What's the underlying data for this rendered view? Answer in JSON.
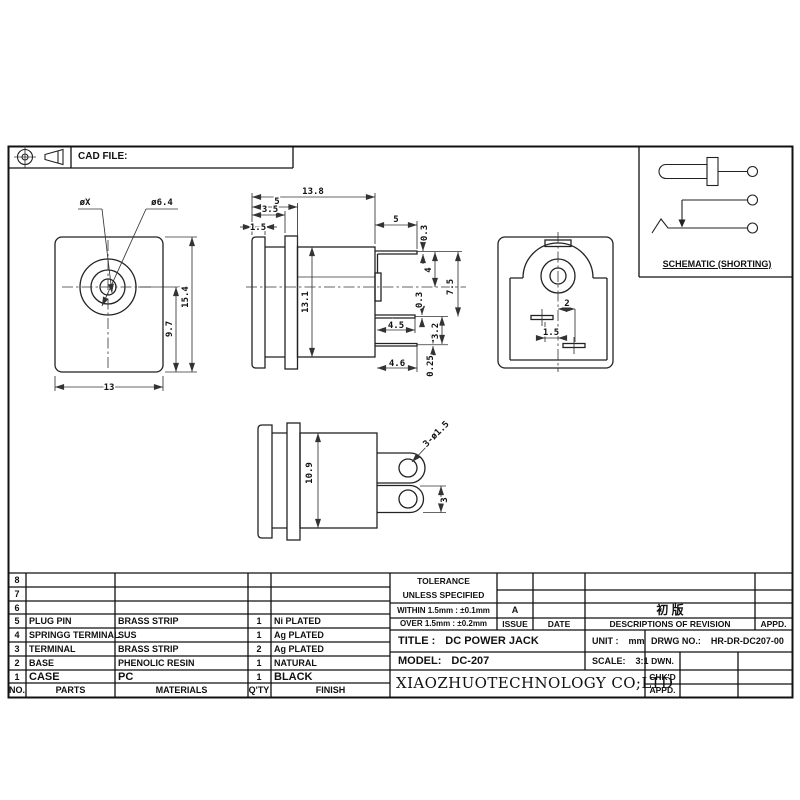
{
  "header": {
    "cad_file_label": "CAD FILE:"
  },
  "schematic": {
    "caption": "SCHEMATIC (SHORTING)"
  },
  "dims": {
    "front": {
      "pin_dia": "øX",
      "opening_dia": "ø6.4",
      "total_height": "15.4",
      "center_to_bottom": "9.7",
      "width": "13"
    },
    "side": {
      "total_depth": "13.8",
      "head_depth": "5",
      "step_depth": "3.5",
      "flange_thickness": "1.5",
      "body_height": "13.1",
      "top_terminal_length": "5",
      "top_terminal_thickness": "0.3",
      "pin_height": "4",
      "terminal_span": "7.5",
      "mid_terminal_thickness": "0.3",
      "mid_terminal_length": "4.5",
      "terminal_gap": "3.2",
      "bottom_terminal_thickness": "0.25",
      "bottom_terminal_length": "4.6"
    },
    "back": {
      "right_slot_offset": "2",
      "left_slot_offset": "1.5"
    },
    "bottom": {
      "body_width": "10.9",
      "hole_spec": "3-ø1.5",
      "terminal_width": "3"
    }
  },
  "parts_table": {
    "headers": {
      "no": "NO.",
      "parts": "PARTS",
      "materials": "MATERIALS",
      "qty": "Q'TY",
      "finish": "FINISH"
    },
    "rows": [
      {
        "no": "8",
        "part": "",
        "material": "",
        "qty": "",
        "finish": ""
      },
      {
        "no": "7",
        "part": "",
        "material": "",
        "qty": "",
        "finish": ""
      },
      {
        "no": "6",
        "part": "",
        "material": "",
        "qty": "",
        "finish": ""
      },
      {
        "no": "5",
        "part": "PLUG PIN",
        "material": "BRASS STRIP",
        "qty": "1",
        "finish": "Ni PLATED"
      },
      {
        "no": "4",
        "part": "SPRINGG TERMINAL",
        "material": "SUS",
        "qty": "1",
        "finish": "Ag PLATED"
      },
      {
        "no": "3",
        "part": "TERMINAL",
        "material": "BRASS STRIP",
        "qty": "2",
        "finish": "Ag PLATED"
      },
      {
        "no": "2",
        "part": "BASE",
        "material": "PHENOLIC RESIN",
        "qty": "1",
        "finish": "NATURAL"
      },
      {
        "no": "1",
        "part": "CASE",
        "material": "PC",
        "qty": "1",
        "finish": "BLACK"
      }
    ]
  },
  "title_block": {
    "tolerance_title": "TOLERANCE",
    "tolerance_subtitle": "UNLESS  SPECIFIED",
    "tolerance_within": "WITHIN 1.5mm : ±0.1mm",
    "tolerance_over": "OVER 1.5mm : ±0.2mm",
    "issue_value": "A",
    "issue_label": "ISSUE",
    "date_label": "DATE",
    "revision_entry": "初 版",
    "revision_label": "DESCRIPTIONS  OF  REVISION",
    "revision_appd_label": "APPD.",
    "title_label": "TITLE :",
    "title_value": "DC POWER JACK",
    "unit_label": "UNIT :",
    "unit_value": "mm",
    "drwg_label": "DRWG NO.:",
    "drwg_value": "HR-DR-DC207-00",
    "model_label": "MODEL:",
    "model_value": "DC-207",
    "scale_label": "SCALE:",
    "scale_value": "3:1",
    "dwn_label": "DWN.",
    "chkd_label": "CHK'D",
    "appd_label": "APPD.",
    "company": "XIAOZHUOTECHNOLOGY  CO;LTD"
  }
}
